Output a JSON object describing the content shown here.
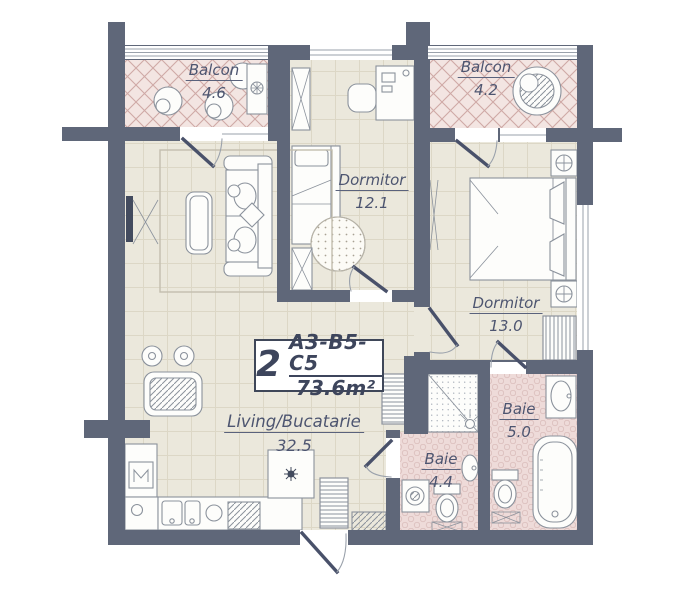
{
  "unit": {
    "rooms_count": "2",
    "code": "A3-B5-C5",
    "total_area": "73.6m²"
  },
  "rooms": [
    {
      "id": "balcony-left",
      "name": "Balcon",
      "area": "4.6"
    },
    {
      "id": "bedroom-small",
      "name": "Dormitor",
      "area": "12.1"
    },
    {
      "id": "balcony-right",
      "name": "Balcon",
      "area": "4.2"
    },
    {
      "id": "bedroom-large",
      "name": "Dormitor",
      "area": "13.0"
    },
    {
      "id": "living-kitchen",
      "name": "Living/Bucatarie",
      "area": "32.5"
    },
    {
      "id": "bathroom-small",
      "name": "Baie",
      "area": "4.4"
    },
    {
      "id": "bathroom-large",
      "name": "Baie",
      "area": "5.0"
    }
  ],
  "colors": {
    "wall": "#5f6779",
    "floor": "#ebe8dc",
    "floor_grid": "#dcd7c6",
    "balcony_floor": "#f3e5e2",
    "balcony_lattice": "#cfa9a6",
    "bath_floor": "#eedbd9",
    "bath_dot": "#dcc0be",
    "furniture_stroke": "#8b929c",
    "door_leaf": "#49516a",
    "label_text": "#4d5570",
    "unit_text": "#3d455c"
  }
}
